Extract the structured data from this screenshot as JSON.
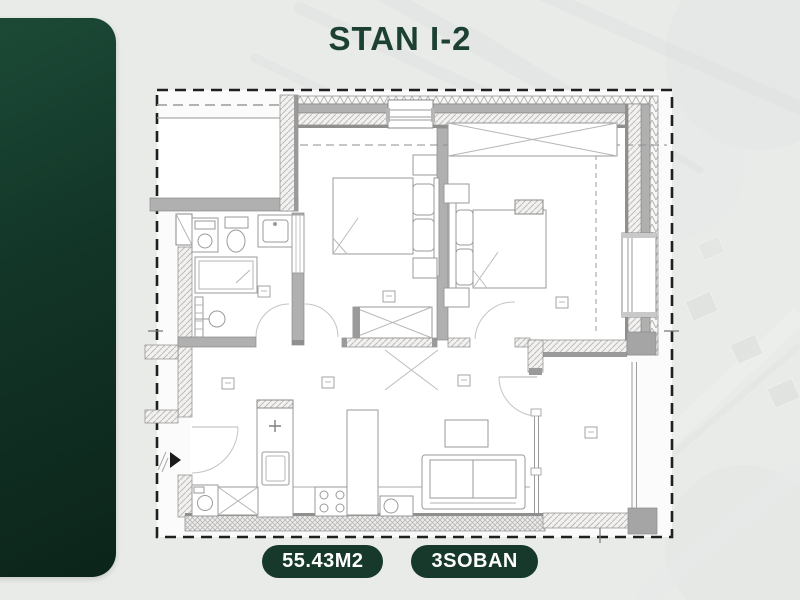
{
  "header": {
    "title": "STAN I-2"
  },
  "badges": {
    "area": "55.43M2",
    "rooms": "3SOBAN"
  },
  "colors": {
    "page_background": "#e9ebe9",
    "accent_dark_green": "#123527",
    "title_green": "#1c4133",
    "badge_background": "#16392b",
    "badge_text": "#ffffff",
    "plan_line_gray": "#8f8f8f"
  }
}
